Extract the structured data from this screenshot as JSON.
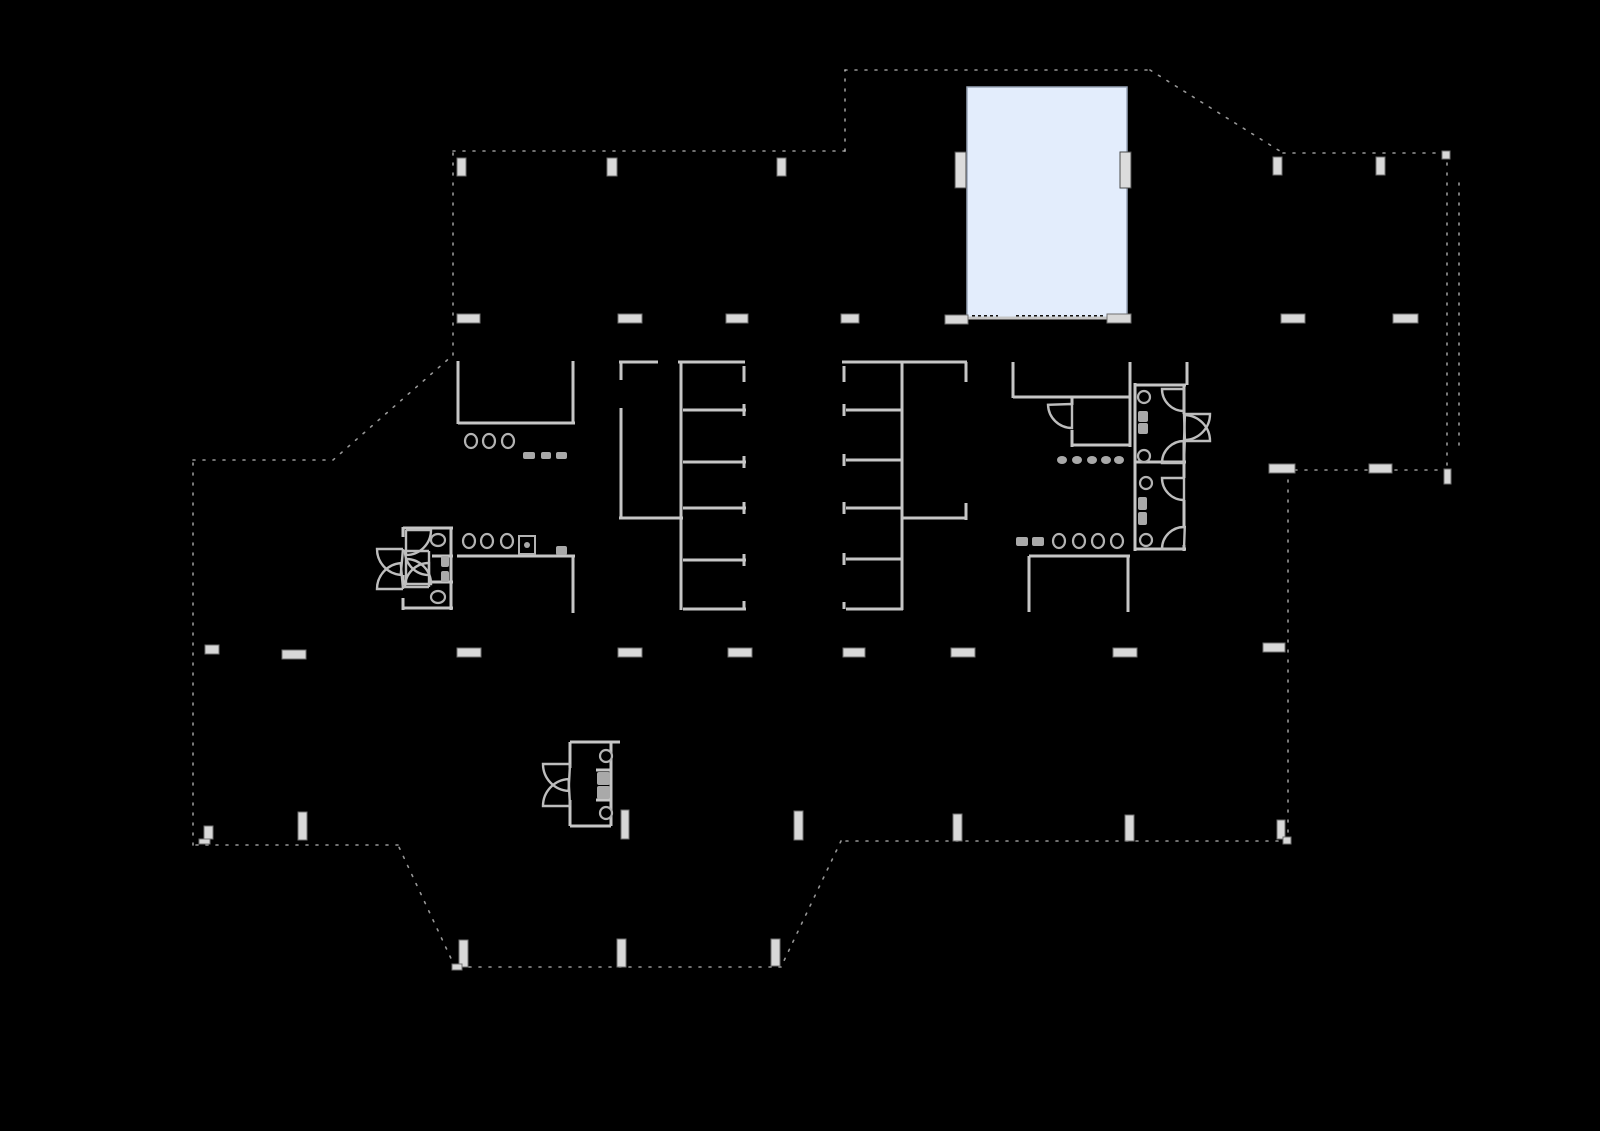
{
  "canvas": {
    "width": 1600,
    "height": 1131,
    "background": "#000000"
  },
  "colors": {
    "wall": "#c6c6c6",
    "boundary": "#c9c9c9",
    "marker_fill": "#d8d8d8",
    "marker_stroke": "#6f6f6f",
    "fixture_stroke": "#b3b3b3",
    "fixture_fill": "#000000",
    "pill_fill": "#a9a9a9",
    "arc_stroke": "#bdbdbd",
    "highlight_fill": "#e3edfc",
    "highlight_border": "#99a5b8",
    "panel_fill": "#dcdcdc",
    "panel_stroke": "#4a4a4a",
    "hatch": "#121212"
  },
  "highlight_room": {
    "x": 967,
    "y": 87,
    "width": 160,
    "height": 231
  },
  "hatches": [
    [
      972,
      317,
      998,
      317
    ],
    [
      1016,
      317,
      1104,
      317
    ]
  ],
  "boundary_segments": [
    [
      453,
      151,
      845,
      151
    ],
    [
      845,
      151,
      845,
      70
    ],
    [
      845,
      70,
      1150,
      70
    ],
    [
      1150,
      70,
      1283,
      153
    ],
    [
      1283,
      153,
      1447,
      153
    ],
    [
      1447,
      153,
      1447,
      483
    ],
    [
      1459,
      183,
      1459,
      446
    ],
    [
      1447,
      470,
      1288,
      470
    ],
    [
      1288,
      470,
      1288,
      841
    ],
    [
      1288,
      841,
      841,
      841
    ],
    [
      841,
      841,
      781,
      967
    ],
    [
      781,
      967,
      455,
      967
    ],
    [
      455,
      967,
      398,
      845
    ],
    [
      398,
      845,
      193,
      845
    ],
    [
      193,
      845,
      193,
      460
    ],
    [
      193,
      460,
      333,
      460
    ],
    [
      333,
      460,
      453,
      355
    ],
    [
      453,
      355,
      453,
      151
    ]
  ],
  "walls": [
    [
      458,
      361,
      458,
      424
    ],
    [
      458,
      423,
      575,
      423
    ],
    [
      573,
      361,
      573,
      423
    ],
    [
      457,
      556,
      575,
      556
    ],
    [
      573,
      556,
      573,
      613
    ],
    [
      621,
      362,
      621,
      380
    ],
    [
      621,
      408,
      621,
      519
    ],
    [
      619,
      362,
      658,
      362
    ],
    [
      678,
      362,
      745,
      362
    ],
    [
      619,
      518,
      683,
      518
    ],
    [
      681,
      362,
      681,
      610
    ],
    [
      683,
      410,
      746,
      410
    ],
    [
      683,
      462,
      746,
      462
    ],
    [
      683,
      508,
      746,
      508
    ],
    [
      683,
      560,
      746,
      560
    ],
    [
      683,
      609,
      746,
      609
    ],
    [
      744,
      366,
      744,
      382
    ],
    [
      744,
      404,
      744,
      416
    ],
    [
      744,
      456,
      744,
      468
    ],
    [
      744,
      502,
      744,
      514
    ],
    [
      744,
      554,
      744,
      566
    ],
    [
      744,
      601,
      744,
      609
    ],
    [
      842,
      362,
      903,
      362
    ],
    [
      903,
      362,
      967,
      362
    ],
    [
      844,
      366,
      844,
      382
    ],
    [
      844,
      404,
      844,
      416
    ],
    [
      844,
      454,
      844,
      466
    ],
    [
      844,
      502,
      844,
      514
    ],
    [
      844,
      553,
      844,
      565
    ],
    [
      844,
      602,
      844,
      609
    ],
    [
      902,
      362,
      902,
      610
    ],
    [
      846,
      410,
      902,
      410
    ],
    [
      846,
      460,
      902,
      460
    ],
    [
      846,
      508,
      902,
      508
    ],
    [
      846,
      559,
      902,
      559
    ],
    [
      846,
      609,
      903,
      609
    ],
    [
      966,
      362,
      966,
      382
    ],
    [
      966,
      503,
      966,
      520
    ],
    [
      903,
      518,
      967,
      518
    ],
    [
      1013,
      362,
      1013,
      398
    ],
    [
      1130,
      362,
      1130,
      447
    ],
    [
      1013,
      397,
      1130,
      397
    ],
    [
      1072,
      397,
      1072,
      405
    ],
    [
      1072,
      430,
      1072,
      447
    ],
    [
      1072,
      445,
      1130,
      445
    ],
    [
      1029,
      556,
      1130,
      556
    ],
    [
      1029,
      556,
      1029,
      612
    ],
    [
      1128,
      556,
      1128,
      612
    ],
    [
      1135,
      383,
      1135,
      462
    ],
    [
      1135,
      385,
      1186,
      385
    ],
    [
      1184,
      385,
      1184,
      414
    ],
    [
      1184,
      441,
      1184,
      462
    ],
    [
      1135,
      462,
      1186,
      462
    ],
    [
      1187,
      362,
      1187,
      385
    ],
    [
      1135,
      462,
      1135,
      551
    ],
    [
      1184,
      462,
      1184,
      478
    ],
    [
      1184,
      500,
      1184,
      527
    ],
    [
      1184,
      545,
      1184,
      551
    ],
    [
      1135,
      549,
      1186,
      549
    ],
    [
      403,
      527,
      403,
      537
    ],
    [
      403,
      575,
      403,
      585
    ],
    [
      403,
      598,
      403,
      610
    ],
    [
      403,
      528,
      453,
      528
    ],
    [
      451,
      528,
      451,
      610
    ],
    [
      403,
      608,
      453,
      608
    ],
    [
      432,
      556,
      453,
      556
    ],
    [
      432,
      582,
      453,
      582
    ],
    [
      570,
      742,
      620,
      742
    ],
    [
      611,
      742,
      611,
      826
    ],
    [
      570,
      826,
      611,
      826
    ],
    [
      570,
      742,
      570,
      768
    ],
    [
      570,
      800,
      570,
      826
    ],
    [
      596,
      770,
      611,
      770
    ],
    [
      596,
      800,
      611,
      800
    ],
    [
      967,
      318,
      1127,
      318
    ]
  ],
  "markers": [
    {
      "x": 457,
      "y": 158,
      "w": 9,
      "h": 18
    },
    {
      "x": 607,
      "y": 158,
      "w": 10,
      "h": 18
    },
    {
      "x": 777,
      "y": 158,
      "w": 9,
      "h": 18
    },
    {
      "x": 1273,
      "y": 157,
      "w": 9,
      "h": 18
    },
    {
      "x": 1376,
      "y": 157,
      "w": 9,
      "h": 18
    },
    {
      "x": 1442,
      "y": 151,
      "w": 8,
      "h": 8
    },
    {
      "x": 457,
      "y": 314,
      "w": 23,
      "h": 9
    },
    {
      "x": 618,
      "y": 314,
      "w": 24,
      "h": 9
    },
    {
      "x": 726,
      "y": 314,
      "w": 22,
      "h": 9
    },
    {
      "x": 841,
      "y": 314,
      "w": 18,
      "h": 9
    },
    {
      "x": 945,
      "y": 315,
      "w": 23,
      "h": 9
    },
    {
      "x": 1107,
      "y": 314,
      "w": 24,
      "h": 9
    },
    {
      "x": 1281,
      "y": 314,
      "w": 24,
      "h": 9
    },
    {
      "x": 1393,
      "y": 314,
      "w": 25,
      "h": 9
    },
    {
      "x": 1269,
      "y": 464,
      "w": 26,
      "h": 9
    },
    {
      "x": 1369,
      "y": 464,
      "w": 23,
      "h": 9
    },
    {
      "x": 1444,
      "y": 469,
      "w": 7,
      "h": 15
    },
    {
      "x": 205,
      "y": 645,
      "w": 14,
      "h": 9
    },
    {
      "x": 282,
      "y": 650,
      "w": 24,
      "h": 9
    },
    {
      "x": 457,
      "y": 648,
      "w": 24,
      "h": 9
    },
    {
      "x": 618,
      "y": 648,
      "w": 24,
      "h": 9
    },
    {
      "x": 728,
      "y": 648,
      "w": 24,
      "h": 9
    },
    {
      "x": 843,
      "y": 648,
      "w": 22,
      "h": 9
    },
    {
      "x": 951,
      "y": 648,
      "w": 24,
      "h": 9
    },
    {
      "x": 1113,
      "y": 648,
      "w": 24,
      "h": 9
    },
    {
      "x": 1263,
      "y": 643,
      "w": 22,
      "h": 9
    },
    {
      "x": 204,
      "y": 826,
      "w": 9,
      "h": 13
    },
    {
      "x": 199,
      "y": 839,
      "w": 11,
      "h": 5
    },
    {
      "x": 298,
      "y": 812,
      "w": 9,
      "h": 28
    },
    {
      "x": 459,
      "y": 940,
      "w": 9,
      "h": 27
    },
    {
      "x": 452,
      "y": 964,
      "w": 10,
      "h": 6
    },
    {
      "x": 617,
      "y": 939,
      "w": 9,
      "h": 28
    },
    {
      "x": 771,
      "y": 939,
      "w": 9,
      "h": 27
    },
    {
      "x": 621,
      "y": 810,
      "w": 8,
      "h": 29
    },
    {
      "x": 794,
      "y": 811,
      "w": 9,
      "h": 29
    },
    {
      "x": 953,
      "y": 814,
      "w": 9,
      "h": 27
    },
    {
      "x": 1125,
      "y": 815,
      "w": 9,
      "h": 26
    },
    {
      "x": 1277,
      "y": 820,
      "w": 8,
      "h": 19
    },
    {
      "x": 1283,
      "y": 837,
      "w": 8,
      "h": 7
    }
  ],
  "door_panels": [
    {
      "x": 955,
      "y": 152,
      "w": 11,
      "h": 36
    },
    {
      "x": 1120,
      "y": 152,
      "w": 11,
      "h": 36
    }
  ],
  "toilets": [
    {
      "cx": 471,
      "cy": 441,
      "rx": 6,
      "ry": 7
    },
    {
      "cx": 489,
      "cy": 441,
      "rx": 6,
      "ry": 7
    },
    {
      "cx": 508,
      "cy": 441,
      "rx": 6,
      "ry": 7
    },
    {
      "cx": 469,
      "cy": 541,
      "rx": 6,
      "ry": 7
    },
    {
      "cx": 487,
      "cy": 541,
      "rx": 6,
      "ry": 7
    },
    {
      "cx": 507,
      "cy": 541,
      "rx": 6,
      "ry": 7
    },
    {
      "cx": 1059,
      "cy": 541,
      "rx": 6,
      "ry": 7
    },
    {
      "cx": 1079,
      "cy": 541,
      "rx": 6,
      "ry": 7
    },
    {
      "cx": 1098,
      "cy": 541,
      "rx": 6,
      "ry": 7
    },
    {
      "cx": 1117,
      "cy": 541,
      "rx": 6,
      "ry": 7
    },
    {
      "cx": 1144,
      "cy": 397,
      "rx": 6,
      "ry": 6
    },
    {
      "cx": 1144,
      "cy": 456,
      "rx": 6,
      "ry": 6
    },
    {
      "cx": 1146,
      "cy": 483,
      "rx": 6,
      "ry": 6
    },
    {
      "cx": 1146,
      "cy": 540,
      "rx": 6,
      "ry": 6
    },
    {
      "cx": 438,
      "cy": 540,
      "rx": 7,
      "ry": 6
    },
    {
      "cx": 438,
      "cy": 597,
      "rx": 7,
      "ry": 6
    },
    {
      "cx": 606,
      "cy": 756,
      "rx": 6,
      "ry": 6
    },
    {
      "cx": 606,
      "cy": 813,
      "rx": 6,
      "ry": 6
    }
  ],
  "dots": [
    {
      "cx": 1062,
      "cy": 460,
      "rx": 5,
      "ry": 4
    },
    {
      "cx": 1077,
      "cy": 460,
      "rx": 5,
      "ry": 4
    },
    {
      "cx": 1092,
      "cy": 460,
      "rx": 5,
      "ry": 4
    },
    {
      "cx": 1106,
      "cy": 460,
      "rx": 5,
      "ry": 4
    },
    {
      "cx": 1119,
      "cy": 460,
      "rx": 5,
      "ry": 4
    },
    {
      "cx": 527,
      "cy": 545,
      "rx": 3,
      "ry": 3
    }
  ],
  "pills": [
    {
      "x": 523,
      "y": 452,
      "w": 12,
      "h": 7
    },
    {
      "x": 541,
      "y": 452,
      "w": 10,
      "h": 7
    },
    {
      "x": 556,
      "y": 452,
      "w": 11,
      "h": 7
    },
    {
      "x": 556,
      "y": 546,
      "w": 11,
      "h": 9
    },
    {
      "x": 1016,
      "y": 537,
      "w": 12,
      "h": 9
    },
    {
      "x": 1032,
      "y": 537,
      "w": 12,
      "h": 9
    },
    {
      "x": 1138,
      "y": 411,
      "w": 10,
      "h": 11
    },
    {
      "x": 1138,
      "y": 423,
      "w": 10,
      "h": 11
    },
    {
      "x": 1138,
      "y": 497,
      "w": 9,
      "h": 13
    },
    {
      "x": 1138,
      "y": 512,
      "w": 9,
      "h": 13
    },
    {
      "x": 441,
      "y": 556,
      "w": 8,
      "h": 11
    },
    {
      "x": 441,
      "y": 571,
      "w": 8,
      "h": 11
    },
    {
      "x": 597,
      "y": 772,
      "w": 13,
      "h": 13
    },
    {
      "x": 597,
      "y": 786,
      "w": 13,
      "h": 13
    }
  ],
  "squares": [
    {
      "x": 519,
      "y": 536,
      "w": 16,
      "h": 18
    }
  ],
  "door_arcs": [
    {
      "cx": 406,
      "cy": 530,
      "r": 25,
      "a0": 90,
      "a1": 0
    },
    {
      "cx": 406,
      "cy": 584,
      "r": 25,
      "a0": -90,
      "a1": 0
    },
    {
      "cx": 403,
      "cy": 549,
      "r": 26,
      "a0": 180,
      "a1": 95
    },
    {
      "cx": 403,
      "cy": 589,
      "r": 26,
      "a0": 180,
      "a1": 265
    },
    {
      "cx": 429,
      "cy": 551,
      "r": 24,
      "a0": 90,
      "a1": 180
    },
    {
      "cx": 429,
      "cy": 587,
      "r": 24,
      "a0": 270,
      "a1": 180
    },
    {
      "cx": 570,
      "cy": 764,
      "r": 27,
      "a0": 180,
      "a1": 93
    },
    {
      "cx": 570,
      "cy": 806,
      "r": 27,
      "a0": 180,
      "a1": 267
    },
    {
      "cx": 1184,
      "cy": 389,
      "r": 22,
      "a0": 90,
      "a1": 180
    },
    {
      "cx": 1184,
      "cy": 414,
      "r": 26,
      "a0": 0,
      "a1": 88
    },
    {
      "cx": 1184,
      "cy": 441,
      "r": 26,
      "a0": 0,
      "a1": -88
    },
    {
      "cx": 1184,
      "cy": 463,
      "r": 22,
      "a0": 180,
      "a1": 272
    },
    {
      "cx": 1184,
      "cy": 478,
      "r": 22,
      "a0": 90,
      "a1": 180
    },
    {
      "cx": 1184,
      "cy": 549,
      "r": 22,
      "a0": 180,
      "a1": 272
    },
    {
      "cx": 1072,
      "cy": 404,
      "r": 24,
      "a0": 90,
      "a1": 178
    }
  ]
}
